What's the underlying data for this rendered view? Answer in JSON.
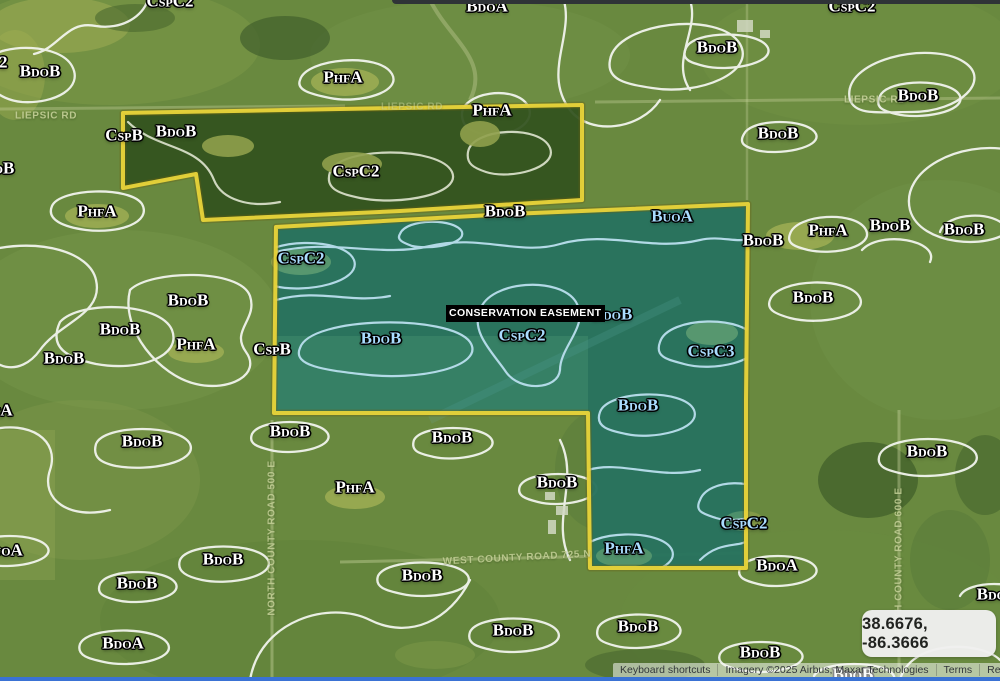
{
  "map": {
    "colors": {
      "boundary_yellow": "#e9d43a",
      "easement_teal": "#1f96a0",
      "label_white": "#ffffff",
      "label_blue": "#aadcff",
      "road_label": "#c3cf96",
      "easement_chip_bg": "#000000",
      "easement_chip_text": "#ffffff",
      "coords_box_bg": "#f1f1f0",
      "coords_text": "#1f1f1f",
      "attribution_text": "#33373b",
      "top_bar": "#2f3337",
      "bottom_bar": "#3a72d4"
    },
    "easement_label": "CONSERVATION EASEMENT",
    "coordinates_tooltip": "38.6676, -86.3666",
    "attribution": {
      "keyboard_shortcuts": "Keyboard shortcuts",
      "imagery": "Imagery ©2025 Airbus, Maxar Technologies",
      "terms": "Terms",
      "report": "Report a map error"
    },
    "soil_labels": [
      {
        "text": "CspC2",
        "x": 170,
        "y": 1,
        "color": "white"
      },
      {
        "text": "BdoA",
        "x": 487,
        "y": 6,
        "color": "white"
      },
      {
        "text": "CspC2",
        "x": 852,
        "y": 6,
        "color": "white"
      },
      {
        "text": "CspC2",
        "x": -16,
        "y": 62,
        "color": "white"
      },
      {
        "text": "BdoB",
        "x": 40,
        "y": 71,
        "color": "white"
      },
      {
        "text": "PhfA",
        "x": 343,
        "y": 77,
        "color": "white"
      },
      {
        "text": "BdoB",
        "x": 717,
        "y": 47,
        "color": "white"
      },
      {
        "text": "BdoB",
        "x": 918,
        "y": 95,
        "color": "white"
      },
      {
        "text": "PhfA",
        "x": 492,
        "y": 110,
        "color": "white"
      },
      {
        "text": "BdoB",
        "x": 778,
        "y": 133,
        "color": "white"
      },
      {
        "text": "CspB",
        "x": 124,
        "y": 135,
        "color": "white"
      },
      {
        "text": "BdoB",
        "x": 176,
        "y": 131,
        "color": "white"
      },
      {
        "text": "BdoB",
        "x": -6,
        "y": 168,
        "color": "white"
      },
      {
        "text": "PhfA",
        "x": 97,
        "y": 211,
        "color": "white"
      },
      {
        "text": "CspC2",
        "x": 356,
        "y": 171,
        "color": "white"
      },
      {
        "text": "BdoB",
        "x": 505,
        "y": 211,
        "color": "white"
      },
      {
        "text": "BuoA",
        "x": 672,
        "y": 216,
        "color": "blue"
      },
      {
        "text": "PhfA",
        "x": 828,
        "y": 230,
        "color": "white"
      },
      {
        "text": "BdoB",
        "x": 890,
        "y": 225,
        "color": "white"
      },
      {
        "text": "BdoB",
        "x": 964,
        "y": 229,
        "color": "white"
      },
      {
        "text": "BdoB",
        "x": 763,
        "y": 240,
        "color": "white"
      },
      {
        "text": "CspC2",
        "x": 301,
        "y": 258,
        "color": "blue"
      },
      {
        "text": "BdoB",
        "x": 813,
        "y": 297,
        "color": "white"
      },
      {
        "text": "BdoB",
        "x": 188,
        "y": 300,
        "color": "white"
      },
      {
        "text": "BdoB",
        "x": 612,
        "y": 314,
        "color": "blue"
      },
      {
        "text": "BdoB",
        "x": 120,
        "y": 329,
        "color": "white"
      },
      {
        "text": "CspC2",
        "x": 522,
        "y": 335,
        "color": "blue"
      },
      {
        "text": "BdoB",
        "x": 381,
        "y": 338,
        "color": "blue"
      },
      {
        "text": "PhfA",
        "x": 196,
        "y": 344,
        "color": "white"
      },
      {
        "text": "CspB",
        "x": 272,
        "y": 349,
        "color": "white"
      },
      {
        "text": "CspC3",
        "x": 711,
        "y": 351,
        "color": "blue"
      },
      {
        "text": "BdoB",
        "x": 64,
        "y": 358,
        "color": "white"
      },
      {
        "text": "BdoB",
        "x": 638,
        "y": 405,
        "color": "blue"
      },
      {
        "text": "PhfA",
        "x": -7,
        "y": 410,
        "color": "white"
      },
      {
        "text": "BdoB",
        "x": 290,
        "y": 431,
        "color": "white"
      },
      {
        "text": "BdoB",
        "x": 452,
        "y": 437,
        "color": "white"
      },
      {
        "text": "BdoB",
        "x": 142,
        "y": 441,
        "color": "white"
      },
      {
        "text": "BdoB",
        "x": 927,
        "y": 451,
        "color": "white"
      },
      {
        "text": "BdoB",
        "x": 557,
        "y": 482,
        "color": "white"
      },
      {
        "text": "PhfA",
        "x": 355,
        "y": 487,
        "color": "white"
      },
      {
        "text": "CspC2",
        "x": 744,
        "y": 523,
        "color": "blue"
      },
      {
        "text": "PhfA",
        "x": 624,
        "y": 548,
        "color": "blue"
      },
      {
        "text": "BuoA",
        "x": 2,
        "y": 550,
        "color": "white"
      },
      {
        "text": "BdoB",
        "x": 223,
        "y": 559,
        "color": "white"
      },
      {
        "text": "BdoA",
        "x": 777,
        "y": 565,
        "color": "white"
      },
      {
        "text": "BdoB",
        "x": 422,
        "y": 575,
        "color": "white"
      },
      {
        "text": "BdoB",
        "x": 137,
        "y": 583,
        "color": "white"
      },
      {
        "text": "BdoB",
        "x": 997,
        "y": 594,
        "color": "white"
      },
      {
        "text": "BdoB",
        "x": 638,
        "y": 626,
        "color": "white"
      },
      {
        "text": "BdoB",
        "x": 513,
        "y": 630,
        "color": "white"
      },
      {
        "text": "BdoA",
        "x": 123,
        "y": 643,
        "color": "white"
      },
      {
        "text": "BdoB",
        "x": 760,
        "y": 652,
        "color": "white"
      },
      {
        "text": "BdoB",
        "x": 853,
        "y": 674,
        "color": "white"
      }
    ],
    "road_labels": [
      {
        "text": "LIEPSIC RD",
        "x": 46,
        "y": 116,
        "rotate": 0,
        "opacity": 0.9
      },
      {
        "text": "LIEPSIC RD",
        "x": 412,
        "y": 107,
        "rotate": 0,
        "opacity": 0.5
      },
      {
        "text": "LIEPSIC RD",
        "x": 875,
        "y": 100,
        "rotate": 0,
        "opacity": 0.9
      },
      {
        "text": "NORTH COUNTY ROAD 500 E",
        "x": 272,
        "y": 538,
        "rotate": -90,
        "opacity": 0.85
      },
      {
        "text": "WEST COUNTY ROAD 725 N",
        "x": 517,
        "y": 558,
        "rotate": -3,
        "opacity": 0.85
      },
      {
        "text": "NORTH COUNTY ROAD 600 E",
        "x": 899,
        "y": 565,
        "rotate": -90,
        "opacity": 0.85
      }
    ]
  }
}
